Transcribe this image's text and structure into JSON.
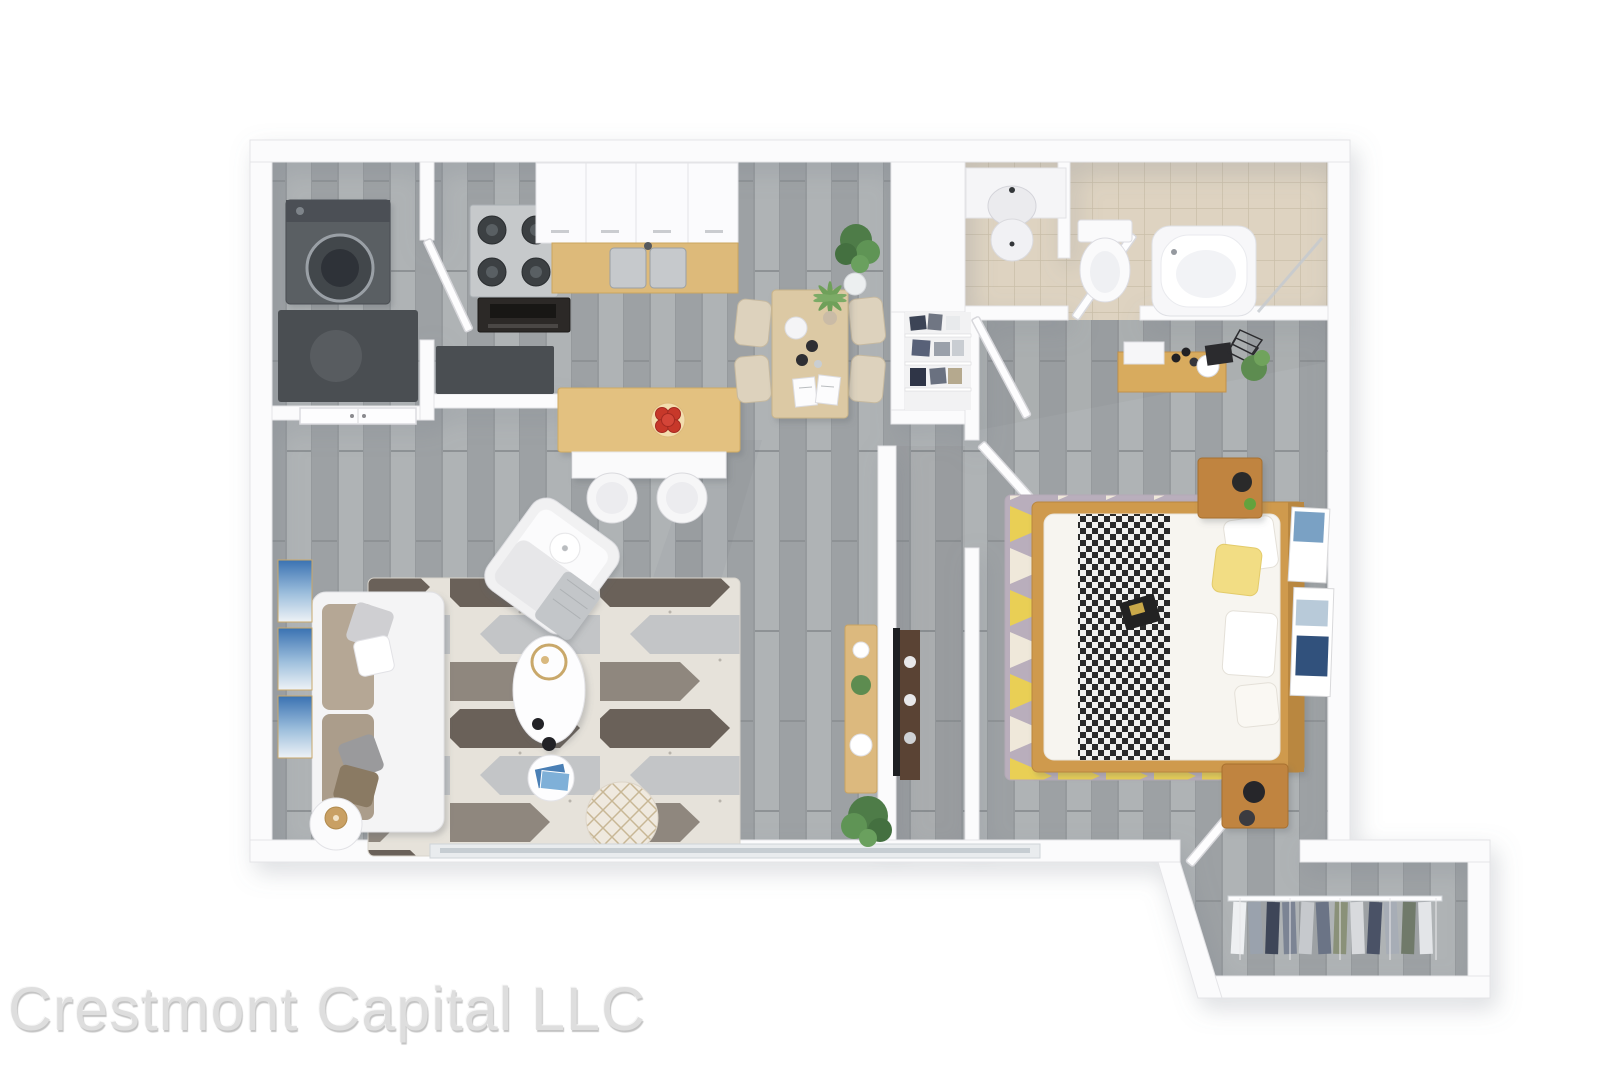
{
  "watermark": {
    "text": "Crestmont Capital LLC"
  },
  "scene": {
    "type": "3d-floor-plan-render",
    "unit": "one-bedroom apartment",
    "rooms": [
      {
        "name": "laundry-closet",
        "furniture": [
          "washing-machine",
          "dark-counter"
        ]
      },
      {
        "name": "kitchen",
        "furniture": [
          "gas-stove",
          "oven",
          "upper-cabinets",
          "wood-counter-double-sink",
          "breakfast-bar",
          "bar-stools",
          "apple-bowl",
          "corner-counter"
        ]
      },
      {
        "name": "dining-area",
        "furniture": [
          "dining-table",
          "dining-chairs",
          "monstera-plant",
          "palm-plant",
          "open-magazine",
          "plate",
          "pots"
        ]
      },
      {
        "name": "living-room",
        "furniture": [
          "sofa",
          "throw-pillows",
          "armchair",
          "knit-throw",
          "chevron-area-rug",
          "coffee-table",
          "round-side-table",
          "magazine-table",
          "pouf",
          "gold-lamp-table",
          "blue-wall-art-triptych",
          "entry-door",
          "window"
        ]
      },
      {
        "name": "hallway",
        "furniture": [
          "linen-closet",
          "folded-clothes"
        ]
      },
      {
        "name": "bathroom",
        "furniture": [
          "vessel-sink",
          "toilet",
          "bathtub",
          "glass-screen",
          "beige-tile-floor"
        ]
      },
      {
        "name": "bedroom",
        "furniture": [
          "double-bed",
          "checkered-throw",
          "yellow-pillow",
          "white-pillows",
          "nightstand-north",
          "nightstand-south",
          "lamps",
          "triangle-area-rug",
          "vanity-shelf",
          "cosmetics",
          "leaning-posters",
          "media-shelf",
          "tv",
          "tv-console",
          "potted-plants"
        ]
      },
      {
        "name": "walk-in-closet",
        "furniture": [
          "wire-shelving",
          "hanging-clothes",
          "closet-door"
        ]
      }
    ]
  },
  "colors": {
    "background": "#ffffff",
    "walls": "#fbfbfc",
    "floor_planks": "#a6aaad",
    "bathroom_tile": "#ded3c1",
    "wood_light": "#ddba7a",
    "wood_medium": "#c58a3e",
    "wood_dark": "#5a4334",
    "sofa_cushion": "#b5a795",
    "rug_dark": "#6a6159",
    "rug_light": "#e6e2da",
    "bedroom_rug_yellow": "#e9cf55",
    "bedroom_rug_plum": "#9a8da2",
    "plant_green": "#5d8c50",
    "art_blue": "#3a72b2",
    "apple_red": "#c7382c",
    "watermark_gray": "#dedede"
  }
}
